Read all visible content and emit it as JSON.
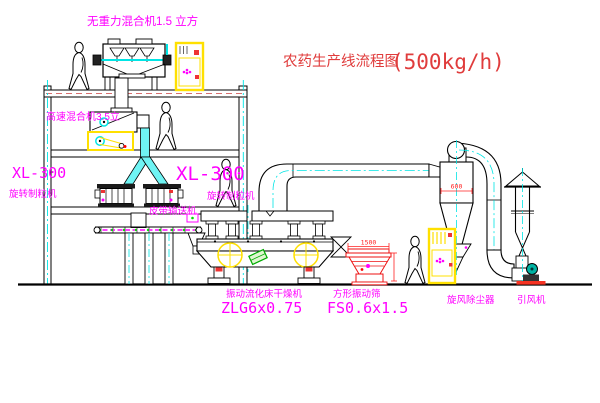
{
  "title": {
    "text": "农药生产线流程图",
    "capacity": "(500kg/h)"
  },
  "labels": {
    "gravity_mixer": "无重力混合机1.5 立方",
    "high_speed_mixer": "高速混合机3.5立",
    "granulator_left": {
      "model": "XL-300",
      "name": "旋转制粒机"
    },
    "granulator_right": {
      "model": "XL-300",
      "name": "旋转制粒机"
    },
    "belt_conveyor": "皮带输送机",
    "dryer": {
      "name": "振动流化床干燥机",
      "model": "ZLG6x0.75"
    },
    "screen": {
      "name": "方形振动筛",
      "model": "FS0.6x1.5"
    },
    "cyclone": "旋风除尘器",
    "fan": "引风机"
  },
  "dimensions": {
    "screen_length": "1500",
    "cyclone_diameter": "600"
  },
  "figures": {
    "workers": 4
  },
  "colors": {
    "label_magenta": "#FF00FF",
    "title_red": "#E03C3C",
    "dimension_red": "#FF2222",
    "centerline_cyan": "#00E5E5",
    "cabinet_yellow": "#FFE000",
    "fan_teal": "#00B3A3",
    "belt_green": "#00DD00"
  }
}
